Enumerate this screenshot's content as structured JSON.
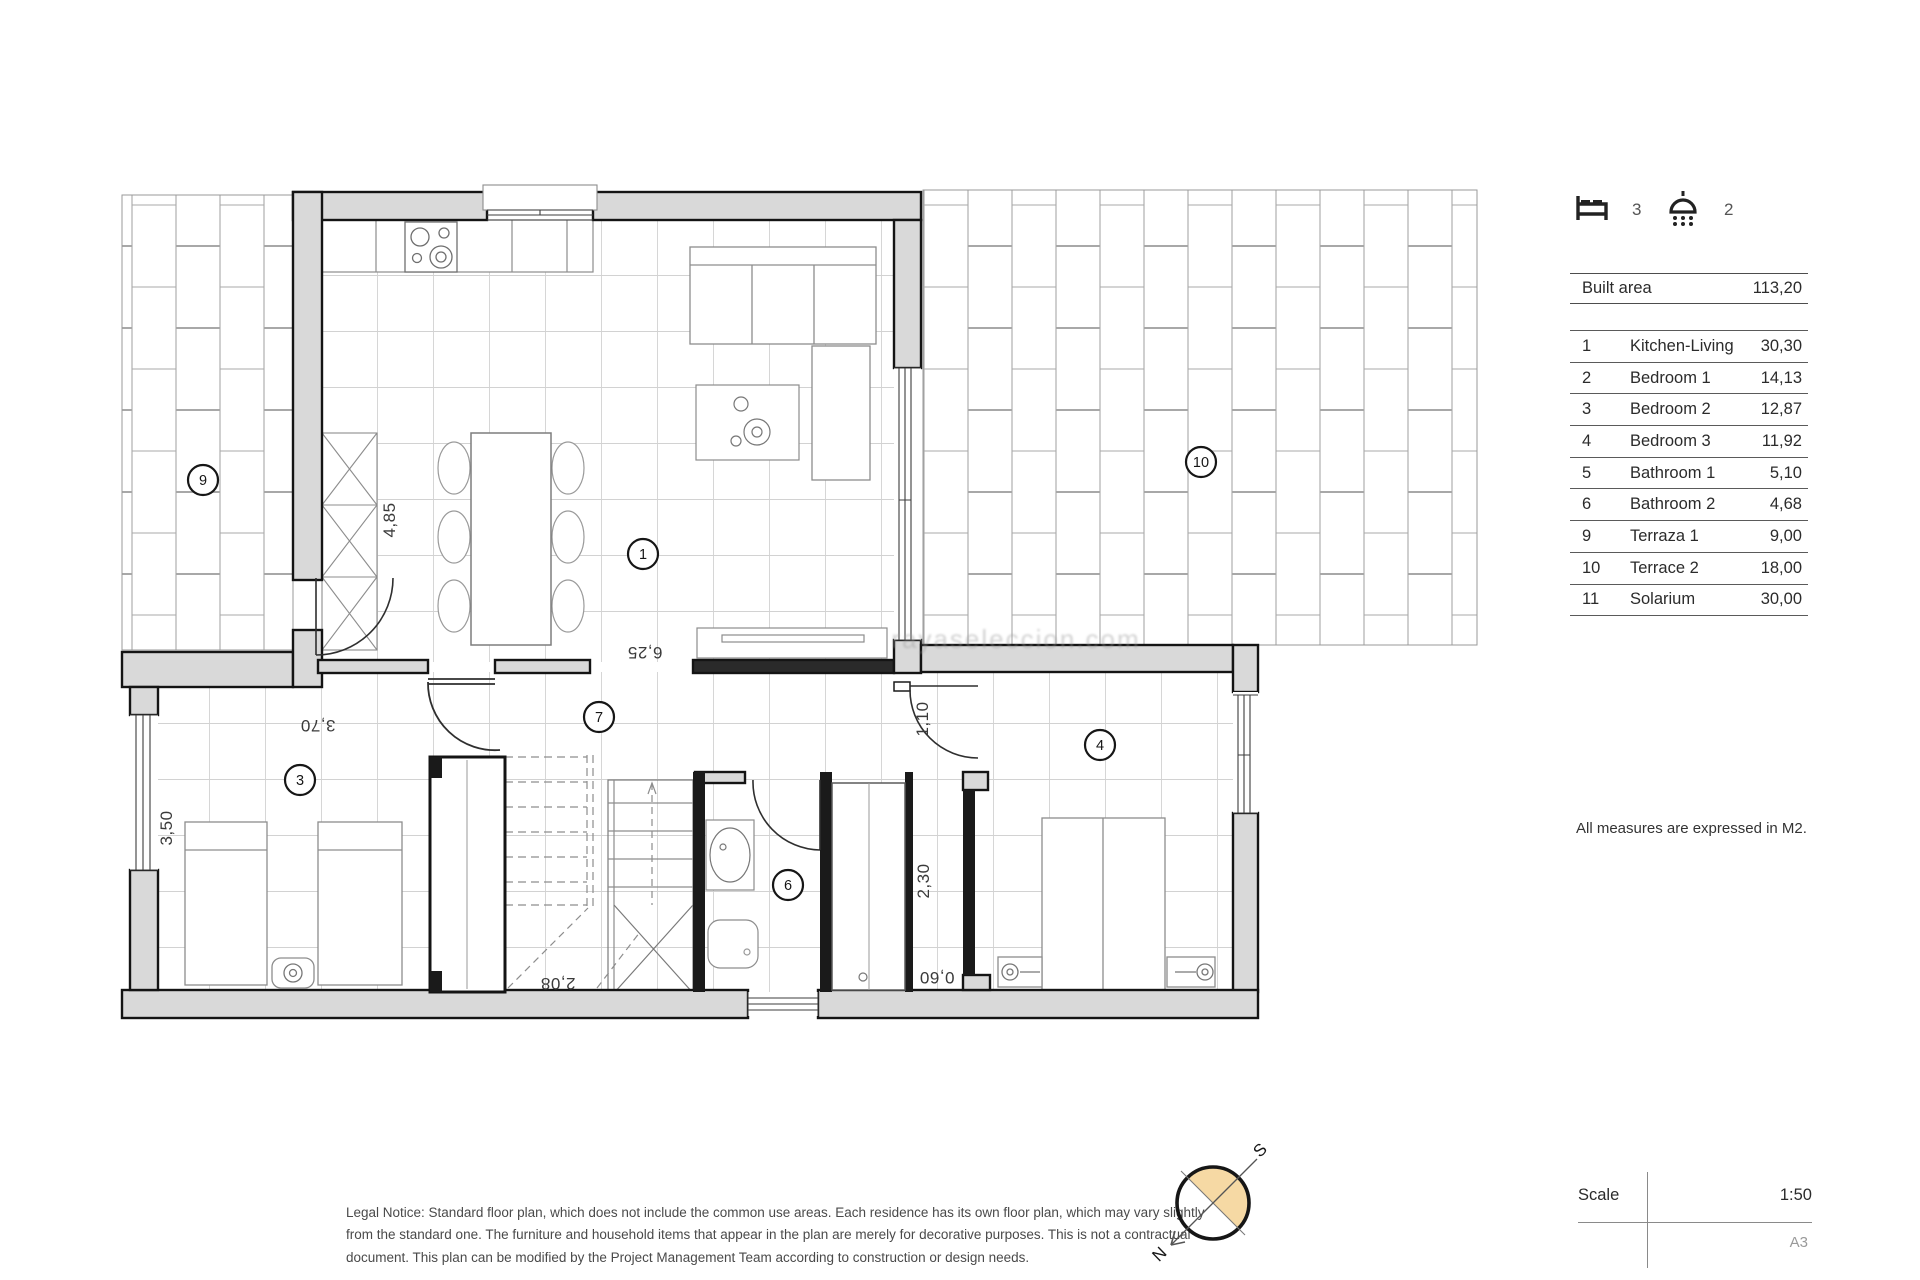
{
  "header": {
    "beds_count": "3",
    "showers_count": "2"
  },
  "areas_table": {
    "built_area_label": "Built area",
    "built_area_value": "113,20",
    "rows": [
      {
        "num": "1",
        "name": "Kitchen-Living",
        "value": "30,30"
      },
      {
        "num": "2",
        "name": "Bedroom 1",
        "value": "14,13"
      },
      {
        "num": "3",
        "name": "Bedroom 2",
        "value": "12,87"
      },
      {
        "num": "4",
        "name": "Bedroom 3",
        "value": "11,92"
      },
      {
        "num": "5",
        "name": "Bathroom 1",
        "value": "5,10"
      },
      {
        "num": "6",
        "name": "Bathroom 2",
        "value": "4,68"
      },
      {
        "num": "9",
        "name": "Terraza 1",
        "value": "9,00"
      },
      {
        "num": "10",
        "name": "Terrace 2",
        "value": "18,00"
      },
      {
        "num": "11",
        "name": "Solarium",
        "value": "30,00"
      }
    ]
  },
  "notes": {
    "measures": "All measures are expressed in M2."
  },
  "legal": {
    "lines": [
      "Legal Notice: Standard floor plan, which does not include the common use areas. Each residence has its own floor plan, which may vary slightly",
      "from the standard one. The furniture and household items that appear in the plan are merely for decorative purposes. This is not a contractual",
      "document. This plan can be modified by the Project Management Team according to construction or design needs."
    ]
  },
  "scale_block": {
    "label": "Scale",
    "value": "1:50",
    "paper": "A3"
  },
  "compass": {
    "north": "N",
    "south": "S"
  },
  "plan": {
    "watermark": "rayaseleccion.com",
    "rooms": {
      "kitchen_living": "1",
      "bedroom2": "3",
      "bedroom3": "4",
      "bathroom2": "6",
      "hall": "7",
      "terraza1": "9",
      "terrace2": "10"
    },
    "dims": {
      "kitchen_depth": "4,85",
      "living_width": "6,25",
      "bedroom3_width": "3,70",
      "bedroom3_depth": "3,50",
      "bed4_door": "1,10",
      "wardrobe_depth": "2,30",
      "closet_width": "0,60",
      "stairs_width": "2,08"
    }
  }
}
